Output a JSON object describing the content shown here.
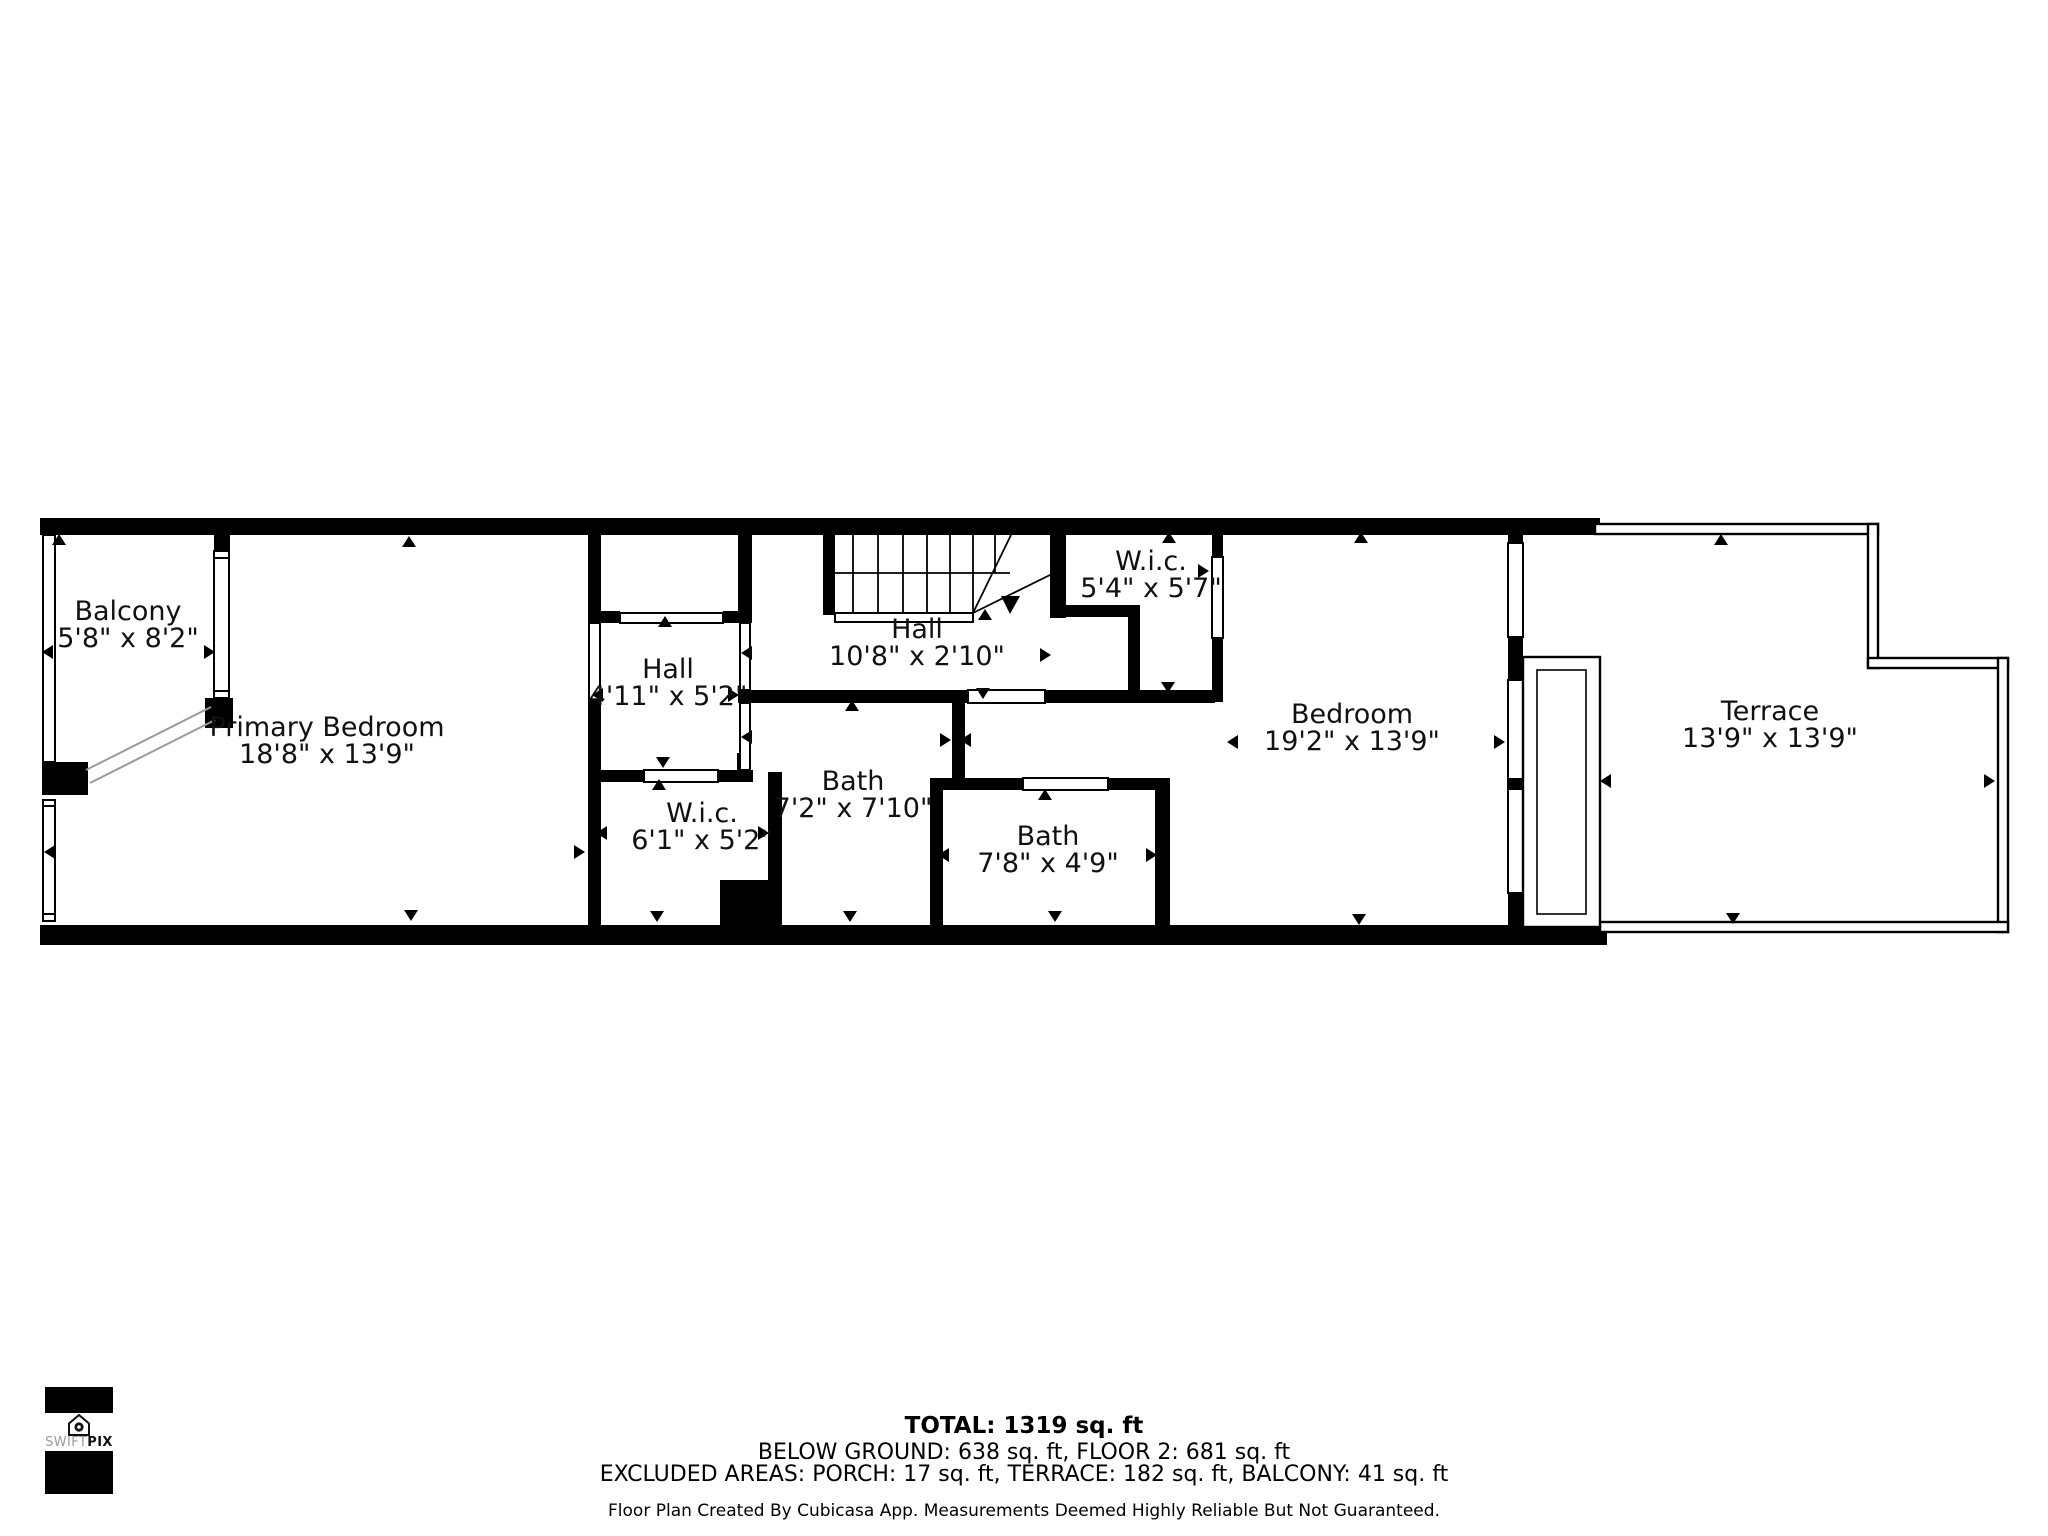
{
  "plan": {
    "rooms": [
      {
        "id": "balcony",
        "name": "Balcony",
        "dims": "5'8\" x 8'2\""
      },
      {
        "id": "primary-bedroom",
        "name": "Primary Bedroom",
        "dims": "18'8\" x 13'9\""
      },
      {
        "id": "hall-small",
        "name": "Hall",
        "dims": "4'11\" x 5'2\""
      },
      {
        "id": "hall-corridor",
        "name": "Hall",
        "dims": "10'8\" x 2'10\""
      },
      {
        "id": "wic-upper",
        "name": "W.i.c.",
        "dims": "5'4\" x 5'7\""
      },
      {
        "id": "wic-lower",
        "name": "W.i.c.",
        "dims": "6'1\" x 5'2\""
      },
      {
        "id": "bath-center",
        "name": "Bath",
        "dims": "7'2\" x 7'10\""
      },
      {
        "id": "bath-right",
        "name": "Bath",
        "dims": "7'8\" x 4'9\""
      },
      {
        "id": "bedroom",
        "name": "Bedroom",
        "dims": "19'2\" x 13'9\""
      },
      {
        "id": "terrace",
        "name": "Terrace",
        "dims": "13'9\" x 13'9\""
      }
    ],
    "wall_color": "#000000",
    "background_color": "#ffffff"
  },
  "footer": {
    "total": "TOTAL: 1319 sq. ft",
    "areas": "BELOW GROUND: 638 sq. ft, FLOOR 2: 681 sq. ft",
    "excluded": "EXCLUDED AREAS: PORCH: 17 sq. ft, TERRACE: 182 sq. ft, BALCONY: 41 sq. ft",
    "disclaimer": "Floor Plan Created By Cubicasa App. Measurements Deemed Highly Reliable But Not Guaranteed."
  },
  "logo": {
    "brand_light": "SWIFT",
    "brand_bold": "PIX"
  }
}
